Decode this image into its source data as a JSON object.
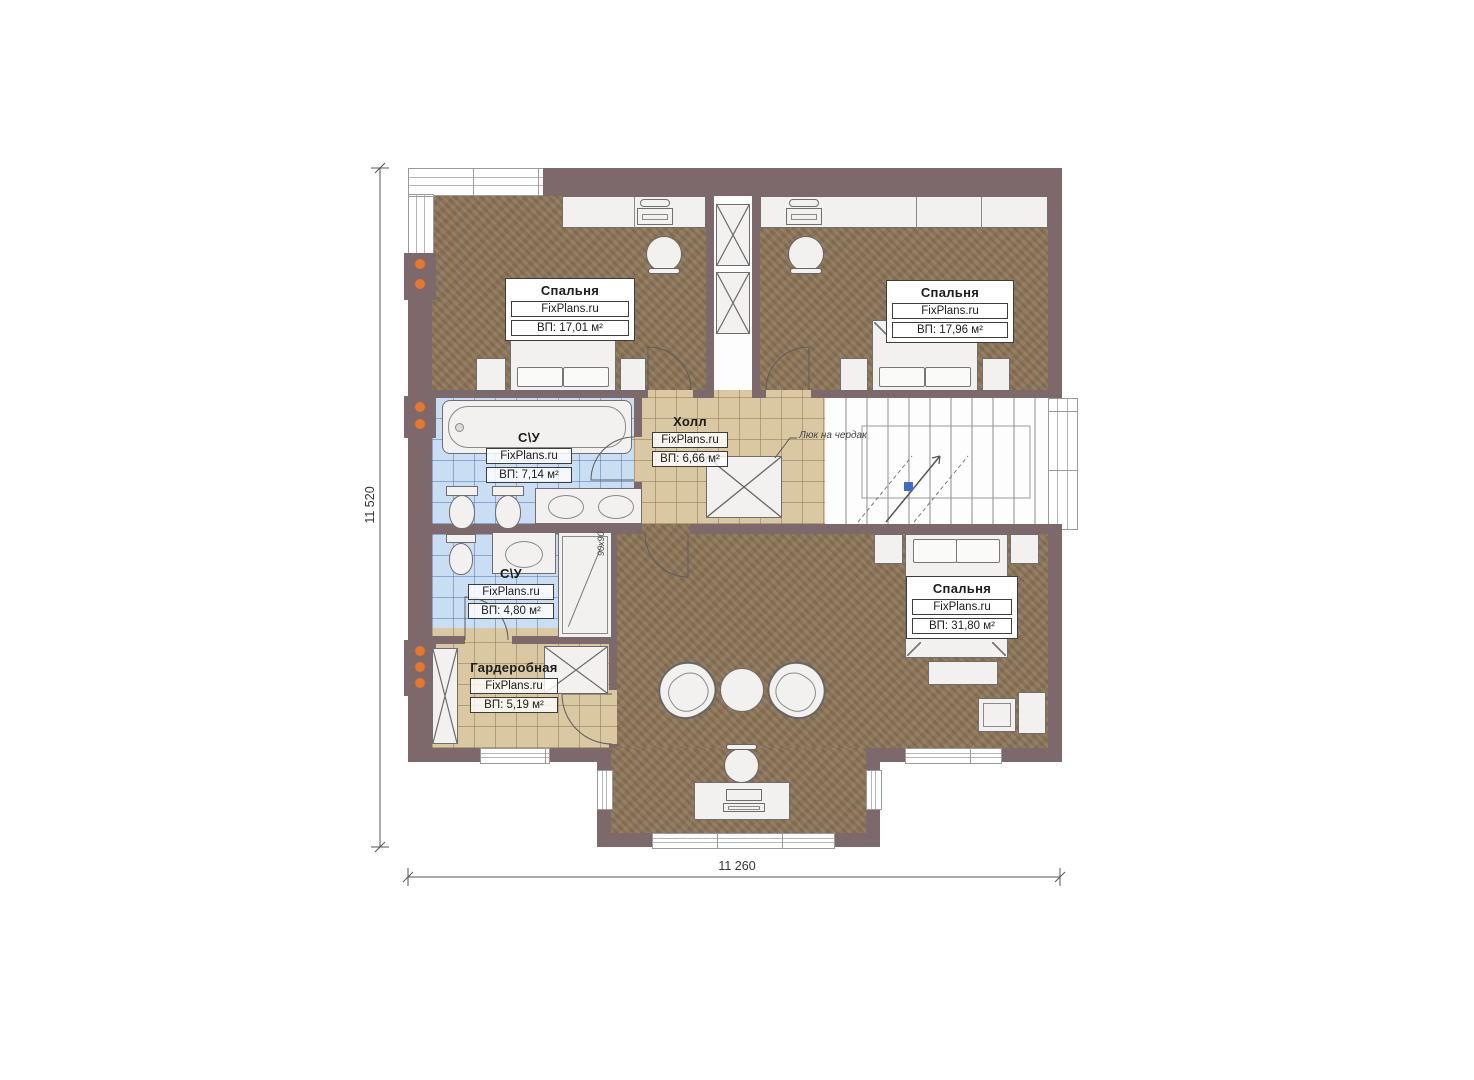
{
  "plan": {
    "dimensions": {
      "height_label": "11 520",
      "width_label": "11 260"
    },
    "rooms": [
      {
        "name": "Спальня",
        "site": "FixPlans.ru",
        "area": "ВП: 17,01 м²"
      },
      {
        "name": "Спальня",
        "site": "FixPlans.ru",
        "area": "ВП: 17,96 м²"
      },
      {
        "name": "С\\У",
        "site": "FixPlans.ru",
        "area": "ВП: 7,14 м²"
      },
      {
        "name": "Холл",
        "site": "FixPlans.ru",
        "area": "ВП: 6,66 м²"
      },
      {
        "name": "С\\У",
        "site": "FixPlans.ru",
        "area": "ВП: 4,80 м²"
      },
      {
        "name": "Гардеробная",
        "site": "FixPlans.ru",
        "area": "ВП: 5,19 м²"
      },
      {
        "name": "Спальня",
        "site": "FixPlans.ru",
        "area": "ВП: 31,80 м²"
      }
    ],
    "annotations": {
      "attic_note": "Люк на чердак",
      "shower_size": "90х90"
    },
    "colors": {
      "wall": "#7d696c",
      "floor_wood": "#8c7456",
      "tile_blue": "#c9def2",
      "tile_tan": "#d9c8a2",
      "accent_orange": "#e8772a",
      "marker_blue": "#3a6fc4"
    }
  }
}
